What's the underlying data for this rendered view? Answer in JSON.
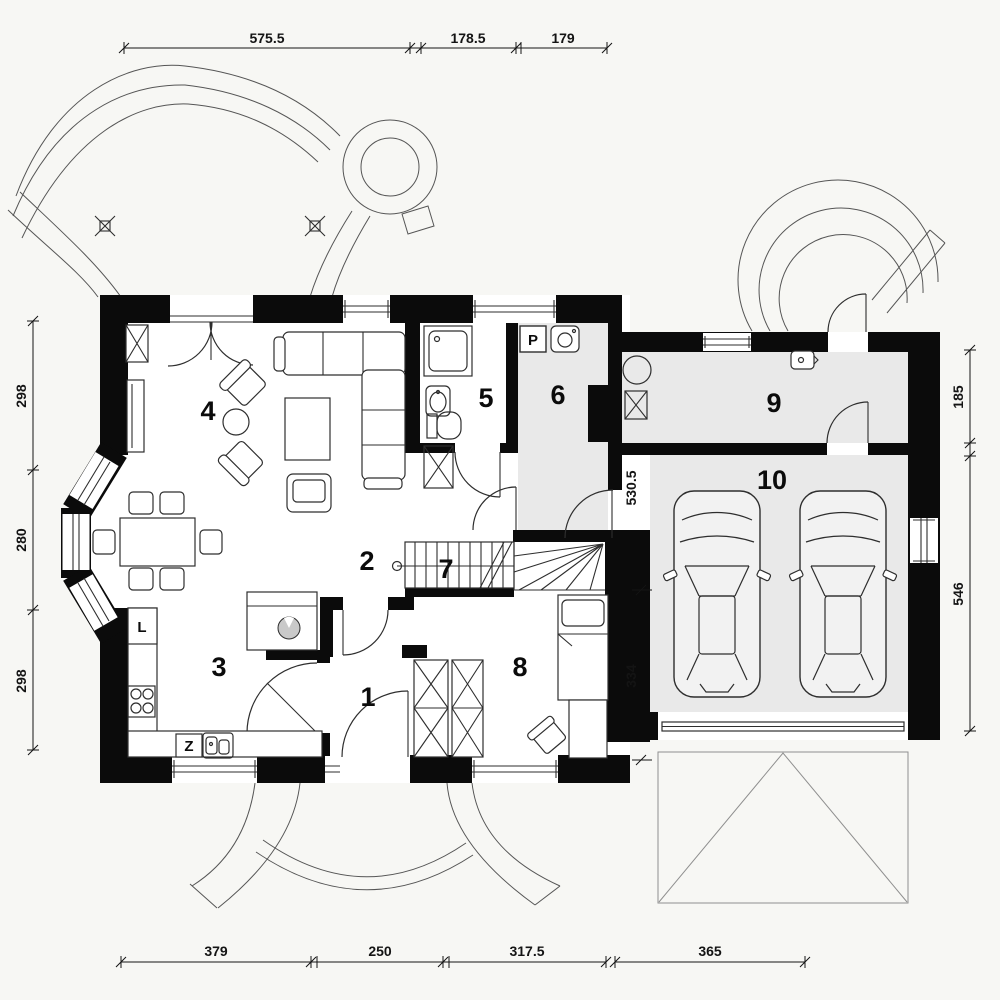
{
  "meta": {
    "drawing_type": "architectural floor plan",
    "view": "ground floor with double garage"
  },
  "colors": {
    "background": "#f7f7f4",
    "wall": "#0b0b0b",
    "line": "#2e2e2e",
    "shaded_floor": "#e9e9e9",
    "roof_line": "#8f8f8f",
    "island_burner": "#c9c9c9"
  },
  "rooms": [
    {
      "number": "1"
    },
    {
      "number": "2"
    },
    {
      "number": "3"
    },
    {
      "number": "4"
    },
    {
      "number": "5"
    },
    {
      "number": "6"
    },
    {
      "number": "7"
    },
    {
      "number": "8"
    },
    {
      "number": "9"
    },
    {
      "number": "10"
    }
  ],
  "appliance_markers": {
    "washer": "P",
    "fridge": "L",
    "dishwasher": "Z"
  },
  "dimensions": {
    "top": [
      "575.5",
      "178.5",
      "179"
    ],
    "bottom": [
      "379",
      "250",
      "317.5",
      "365"
    ],
    "left": [
      "298",
      "280",
      "298"
    ],
    "right": [
      "185",
      "546"
    ],
    "garage_interior": [
      "530.5",
      "334"
    ]
  }
}
